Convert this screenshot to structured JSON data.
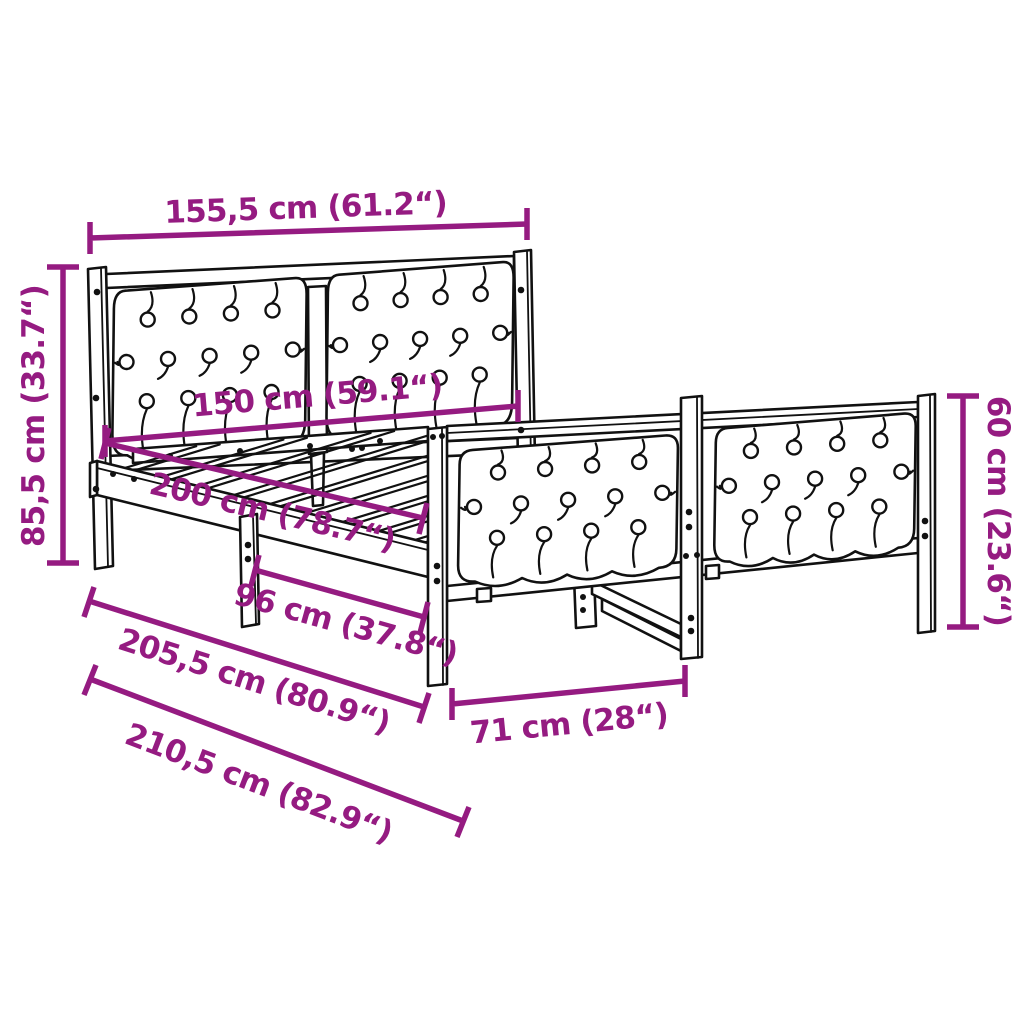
{
  "diagram": {
    "colors": {
      "dimension": "#951b81",
      "line_art": "#111111",
      "background": "#ffffff"
    },
    "dimensions": [
      {
        "id": "overall-width",
        "label": "155,5 cm (61.2“)"
      },
      {
        "id": "headboard-height",
        "label": "85,5 cm (33.7“)"
      },
      {
        "id": "inner-width",
        "label": "150 cm (59.1“)"
      },
      {
        "id": "inner-length",
        "label": "200 cm (78.7“)"
      },
      {
        "id": "support-leg-distance",
        "label": "96 cm (37.8“)"
      },
      {
        "id": "frame-length",
        "label": "205,5 cm (80.9“)"
      },
      {
        "id": "overall-length",
        "label": "210,5 cm (82.9“)"
      },
      {
        "id": "footboard-section-width",
        "label": "71 cm (28“)"
      },
      {
        "id": "footboard-height",
        "label": "60 cm (23.6“)"
      }
    ]
  }
}
